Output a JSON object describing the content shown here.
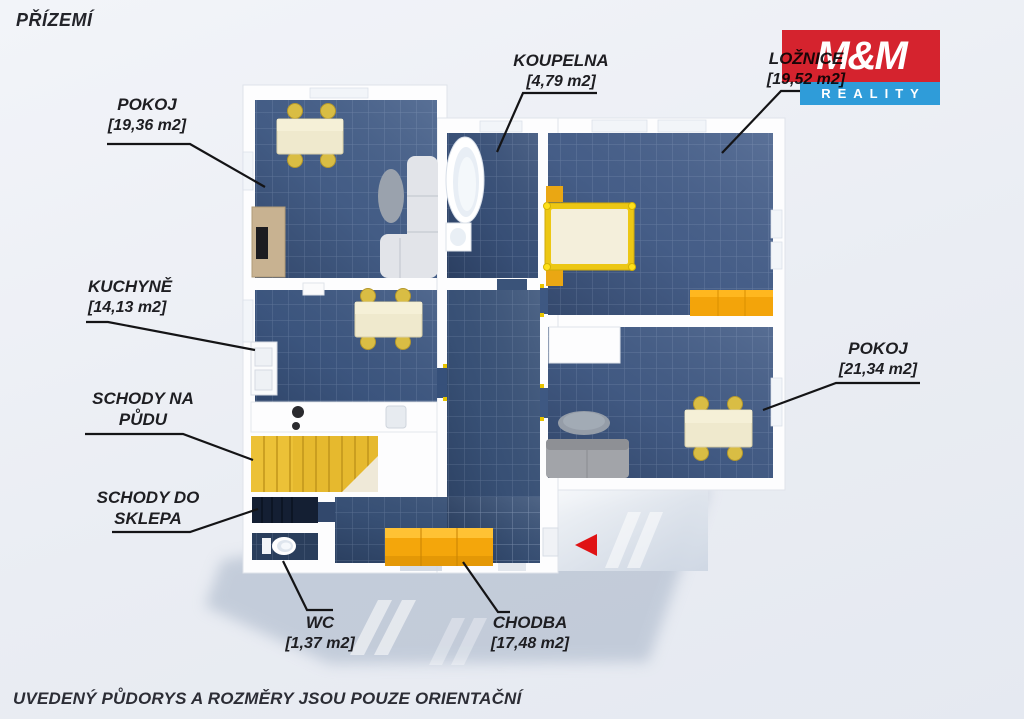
{
  "header": {
    "floor_title": "PŘÍZEMÍ"
  },
  "footer": {
    "disclaimer": "UVEDENÝ PŮDORYS A ROZMĚRY JSOU POUZE ORIENTAČNÍ"
  },
  "logo": {
    "top": "M&M",
    "bottom": "REALITY",
    "red": "#d5232e",
    "blue": "#2f9cd9"
  },
  "rooms": [
    {
      "id": "pokoj-horni",
      "name": "POKOJ",
      "area": "[19,36 m2]"
    },
    {
      "id": "koupelna",
      "name": "KOUPELNA",
      "area": "[4,79 m2]"
    },
    {
      "id": "loznice",
      "name": "LOŽNICE",
      "area": "[19,52 m2]"
    },
    {
      "id": "kuchyne",
      "name": "KUCHYNĚ",
      "area": "[14,13 m2]"
    },
    {
      "id": "schody-na-pudu",
      "name": "SCHODY NA PŮDU",
      "area": ""
    },
    {
      "id": "schody-do-sklepa",
      "name": "SCHODY DO SKLEPA",
      "area": ""
    },
    {
      "id": "wc",
      "name": "WC",
      "area": "[1,37 m2]"
    },
    {
      "id": "chodba",
      "name": "CHODBA",
      "area": "[17,48 m2]"
    },
    {
      "id": "pokoj-dolni",
      "name": "POKOJ",
      "area": "[21,34 m2]"
    }
  ],
  "palette": {
    "background": "#eaedf3",
    "floor_blue": "#3c5477",
    "wall_white": "#ffffff",
    "furniture_cream": "#efe9cd",
    "chair_yellow": "#d9bd44",
    "stairs_yellow": "#e6b92e",
    "cabinet_orange": "#f4a60b",
    "bed_frame_yellow": "#ecc714",
    "sofa_gray": "#a2a4a9",
    "label_text": "#1e1e22",
    "leader_line": "#141416",
    "entrance_arrow_red": "#e01315"
  }
}
